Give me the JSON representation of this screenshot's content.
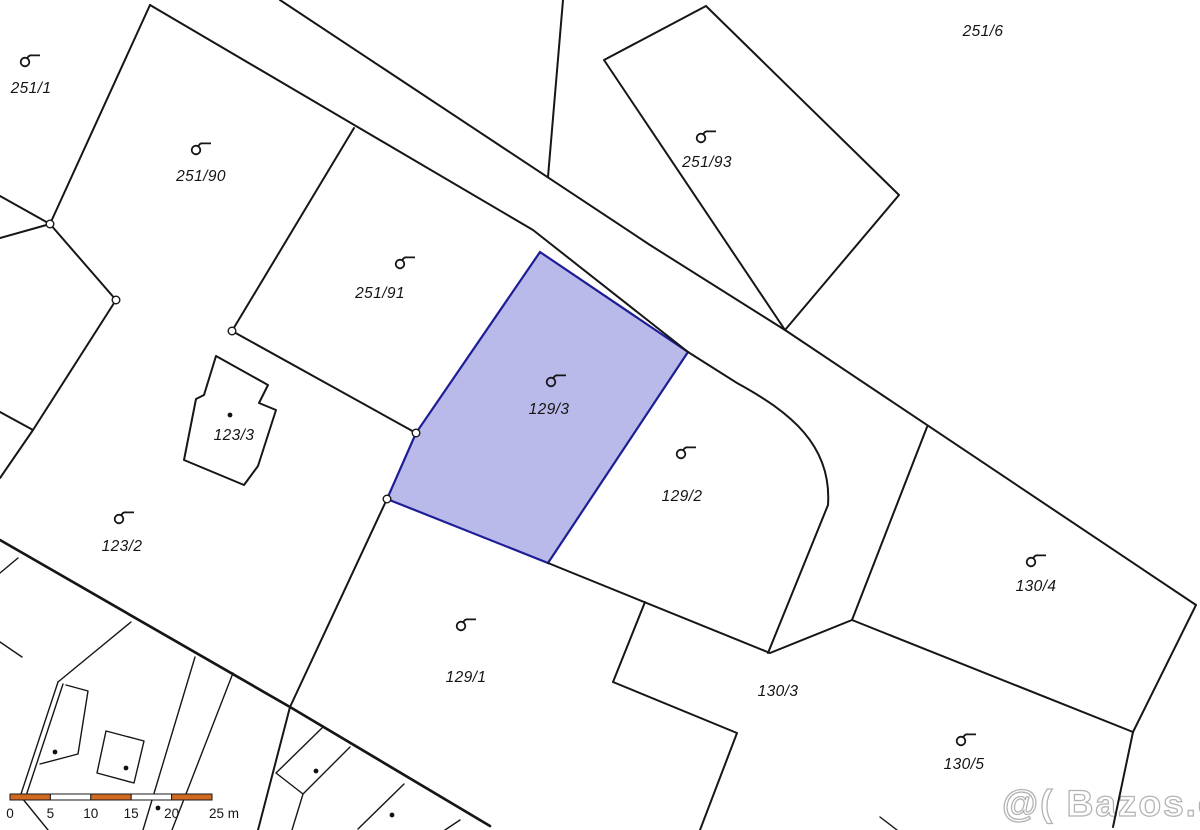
{
  "map": {
    "title": "cadastral-map",
    "parcels": [
      {
        "id": "251/1",
        "label_x": 31,
        "label_y": 93,
        "icon": true,
        "icon_x": 25,
        "icon_y": 62,
        "highlighted": false
      },
      {
        "id": "251/90",
        "label_x": 201,
        "label_y": 181,
        "icon": true,
        "icon_x": 196,
        "icon_y": 150,
        "highlighted": false
      },
      {
        "id": "251/91",
        "label_x": 380,
        "label_y": 298,
        "icon": true,
        "icon_x": 400,
        "icon_y": 264,
        "highlighted": false
      },
      {
        "id": "251/93",
        "label_x": 707,
        "label_y": 167,
        "icon": true,
        "icon_x": 701,
        "icon_y": 138,
        "highlighted": false
      },
      {
        "id": "251/6",
        "label_x": 983,
        "label_y": 36,
        "icon": false,
        "icon_x": 0,
        "icon_y": 0,
        "highlighted": false
      },
      {
        "id": "129/3",
        "label_x": 549,
        "label_y": 414,
        "icon": true,
        "icon_x": 551,
        "icon_y": 382,
        "highlighted": true
      },
      {
        "id": "129/2",
        "label_x": 682,
        "label_y": 501,
        "icon": true,
        "icon_x": 681,
        "icon_y": 454,
        "highlighted": false
      },
      {
        "id": "123/3",
        "label_x": 234,
        "label_y": 440,
        "icon": false,
        "icon_x": 0,
        "icon_y": 0,
        "highlighted": false
      },
      {
        "id": "123/2",
        "label_x": 122,
        "label_y": 551,
        "icon": true,
        "icon_x": 119,
        "icon_y": 519,
        "highlighted": false
      },
      {
        "id": "129/1",
        "label_x": 466,
        "label_y": 682,
        "icon": true,
        "icon_x": 461,
        "icon_y": 626,
        "highlighted": false
      },
      {
        "id": "130/3",
        "label_x": 778,
        "label_y": 696,
        "icon": false,
        "icon_x": 0,
        "icon_y": 0,
        "highlighted": false
      },
      {
        "id": "130/4",
        "label_x": 1036,
        "label_y": 591,
        "icon": true,
        "icon_x": 1031,
        "icon_y": 562,
        "highlighted": false
      },
      {
        "id": "130/5",
        "label_x": 964,
        "label_y": 769,
        "icon": true,
        "icon_x": 961,
        "icon_y": 741,
        "highlighted": false
      }
    ],
    "highlight": {
      "fill": "#b9b9ea",
      "stroke": "#1d1d96",
      "parcel": "129/3"
    },
    "boundary_points": [
      [
        50,
        224
      ],
      [
        116,
        300
      ],
      [
        232,
        331
      ],
      [
        416,
        433
      ],
      [
        387,
        499
      ]
    ],
    "building_dots": [
      [
        230,
        415
      ],
      [
        55,
        752
      ],
      [
        126,
        768
      ],
      [
        158,
        808
      ],
      [
        316,
        771
      ],
      [
        392,
        815
      ]
    ],
    "scale_bar": {
      "ticks": [
        "0",
        "5",
        "10",
        "15",
        "20",
        "25 m"
      ],
      "bar_color": "#d06a20",
      "alt_color": "#ffffff",
      "outline_color": "#1a1a1a"
    },
    "watermark": {
      "text": "@( Bazos.cz"
    }
  }
}
